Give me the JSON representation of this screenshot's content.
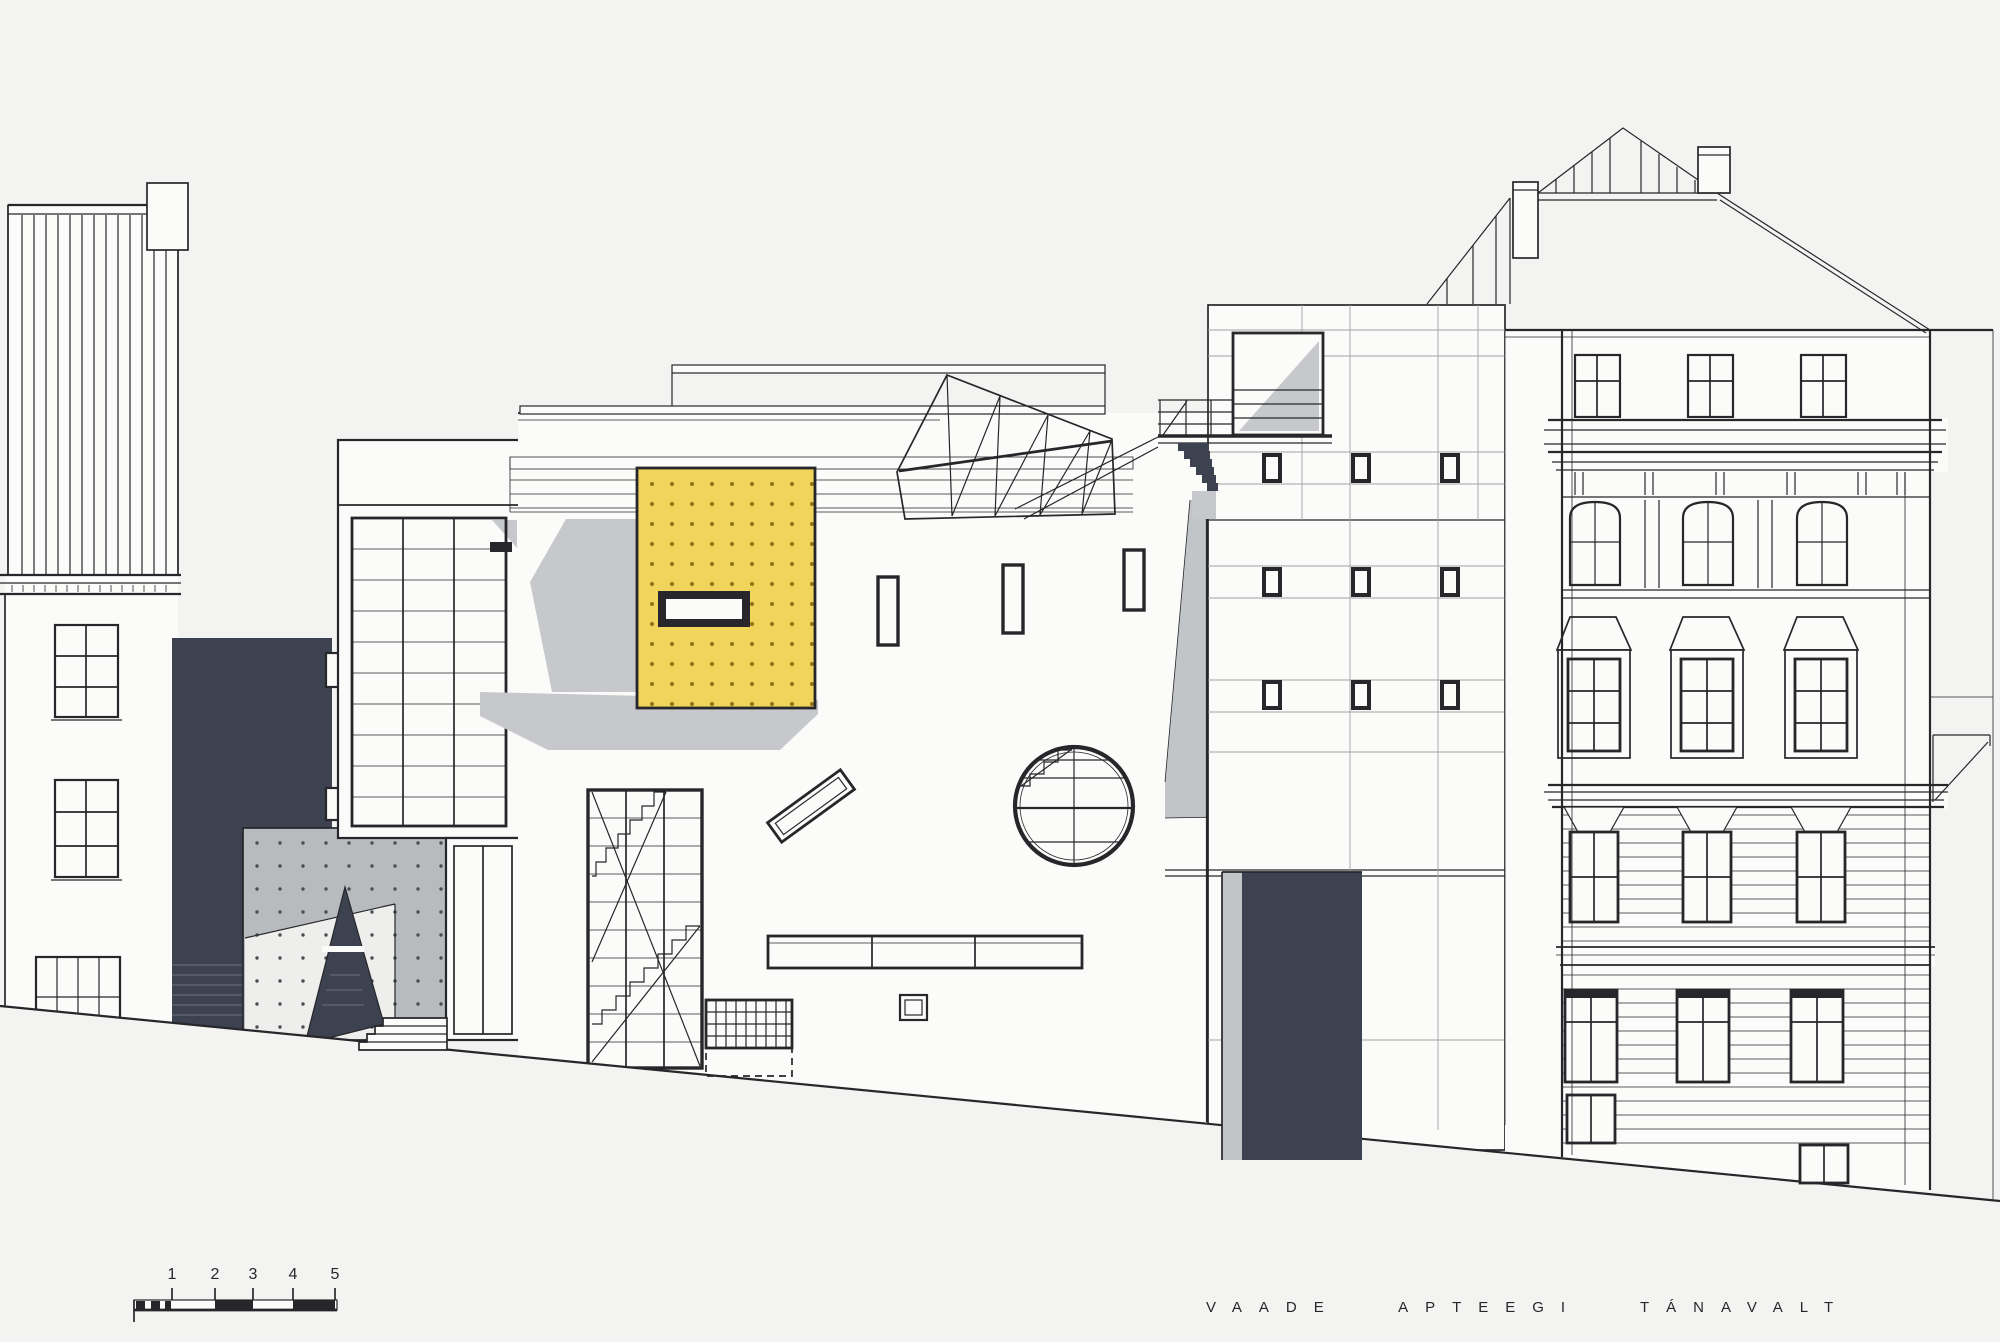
{
  "caption": {
    "text": "VAADE APTEEGI TÁNAVALT"
  },
  "scale_bar": {
    "labels": [
      "1",
      "2",
      "3",
      "4",
      "5"
    ]
  },
  "colors": {
    "paper": "#f3f3f1",
    "white": "#fbfbfa",
    "ink": "#27272b",
    "faint": "#a0a2a4",
    "navy": "#3c4250",
    "yellow": "#f0d45c",
    "yellow_dot": "#8f7414",
    "shadow": "#c6c8cb",
    "panel": "#b8bbbe",
    "panel_light": "#eeeeec",
    "step_line": "#6a7080"
  }
}
